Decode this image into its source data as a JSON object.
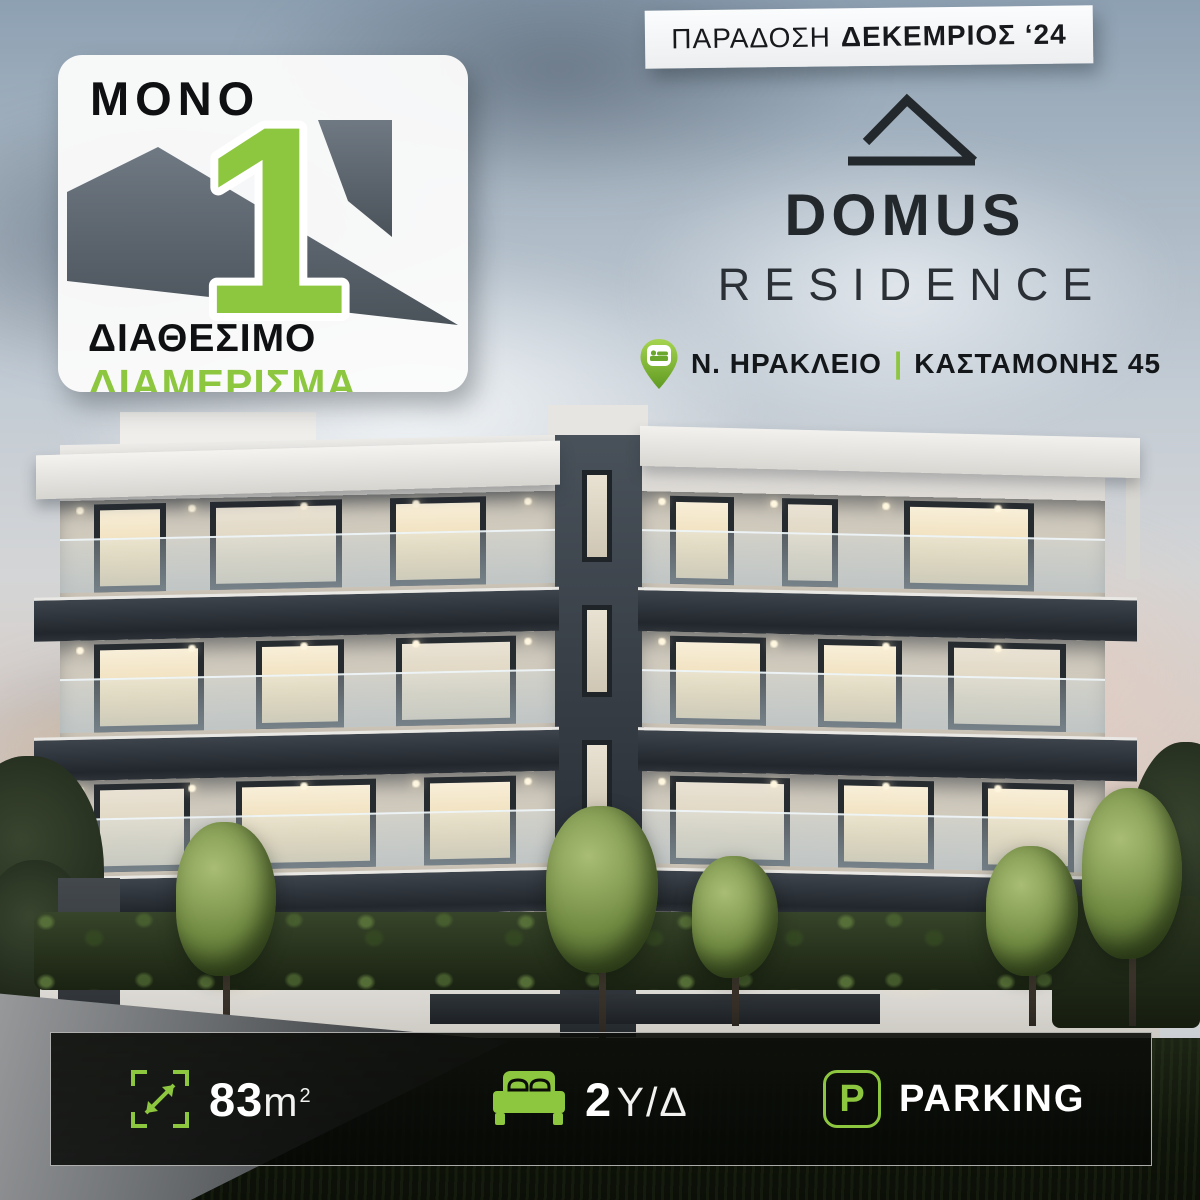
{
  "page": {
    "kind": "real-estate-advertisement",
    "project": "DOMUS RESIDENCE"
  },
  "delivery_badge": {
    "prefix": "ΠΑΡΑΔΟΣΗ",
    "emphasis": "ΔΕΚΕΜΡΙΟΣ ‘24"
  },
  "availability_badge": {
    "top_word": "MONO",
    "number": "1",
    "line1": "ΔΙΑΘΕΣΙΜΟ",
    "line2": "ΔΙΑΜΕΡΙΣΜΑ"
  },
  "logo": {
    "name": "DOMUS",
    "subtitle": "RESIDENCE",
    "icon": "roof-outline-icon"
  },
  "location": {
    "pin_icon": "location-pin-bed-icon",
    "area": "Ν. ΗΡΑΚΛΕΙΟ",
    "separator": "|",
    "street": "ΚΑΣΤΑΜΟΝΗΣ 45"
  },
  "features": [
    {
      "icon": "expand-icon",
      "value": "83",
      "unit": "m",
      "superscript": "2"
    },
    {
      "icon": "bed-icon",
      "value": "2",
      "unit": "Υ/Δ"
    },
    {
      "icon": "parking-icon",
      "letter": "P",
      "label": "PARKING"
    }
  ],
  "colors": {
    "accent_green": "#8dc63f",
    "dark_text": "#1b2025",
    "slab_dark": "#2b3138",
    "badge_bg": "#fbfbfb"
  }
}
